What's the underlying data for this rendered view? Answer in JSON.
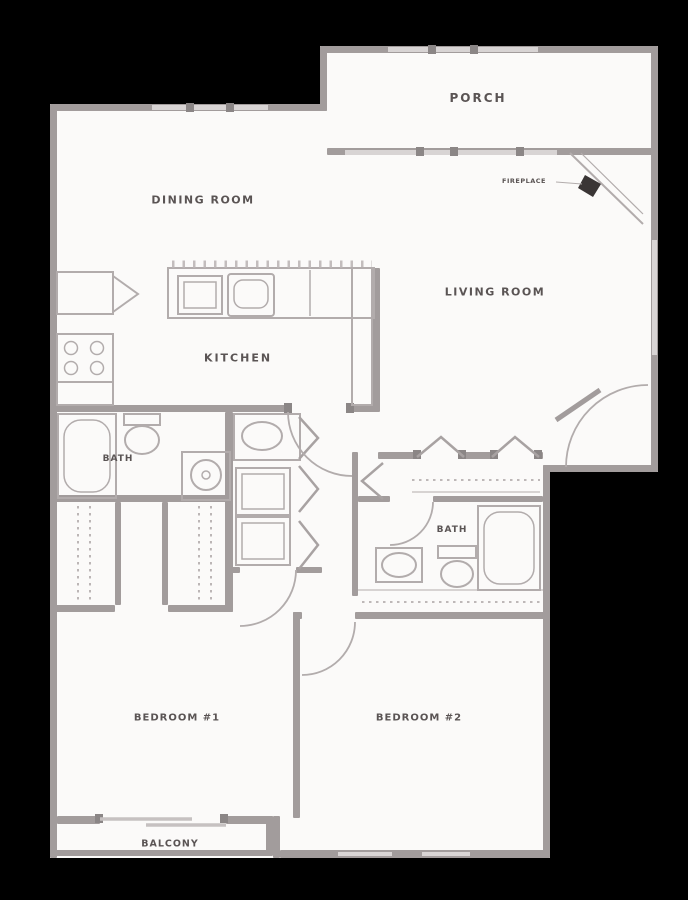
{
  "floorplan": {
    "rooms": {
      "porch": "PORCH",
      "dining_room": "DINING ROOM",
      "living_room": "LIVING ROOM",
      "kitchen": "KITCHEN",
      "bath": "BATH",
      "bedroom_1": "BEDROOM #1",
      "bedroom_2": "BEDROOM #2",
      "balcony": "BALCONY"
    },
    "annotations": {
      "fireplace": "FIREPLACE"
    },
    "colors": {
      "background": "#000000",
      "floor": "#fbfaf9",
      "wall": "#a29c9c",
      "window": "#d8d4d4",
      "fixture": "#b2acac",
      "label": "#5a5454"
    }
  }
}
